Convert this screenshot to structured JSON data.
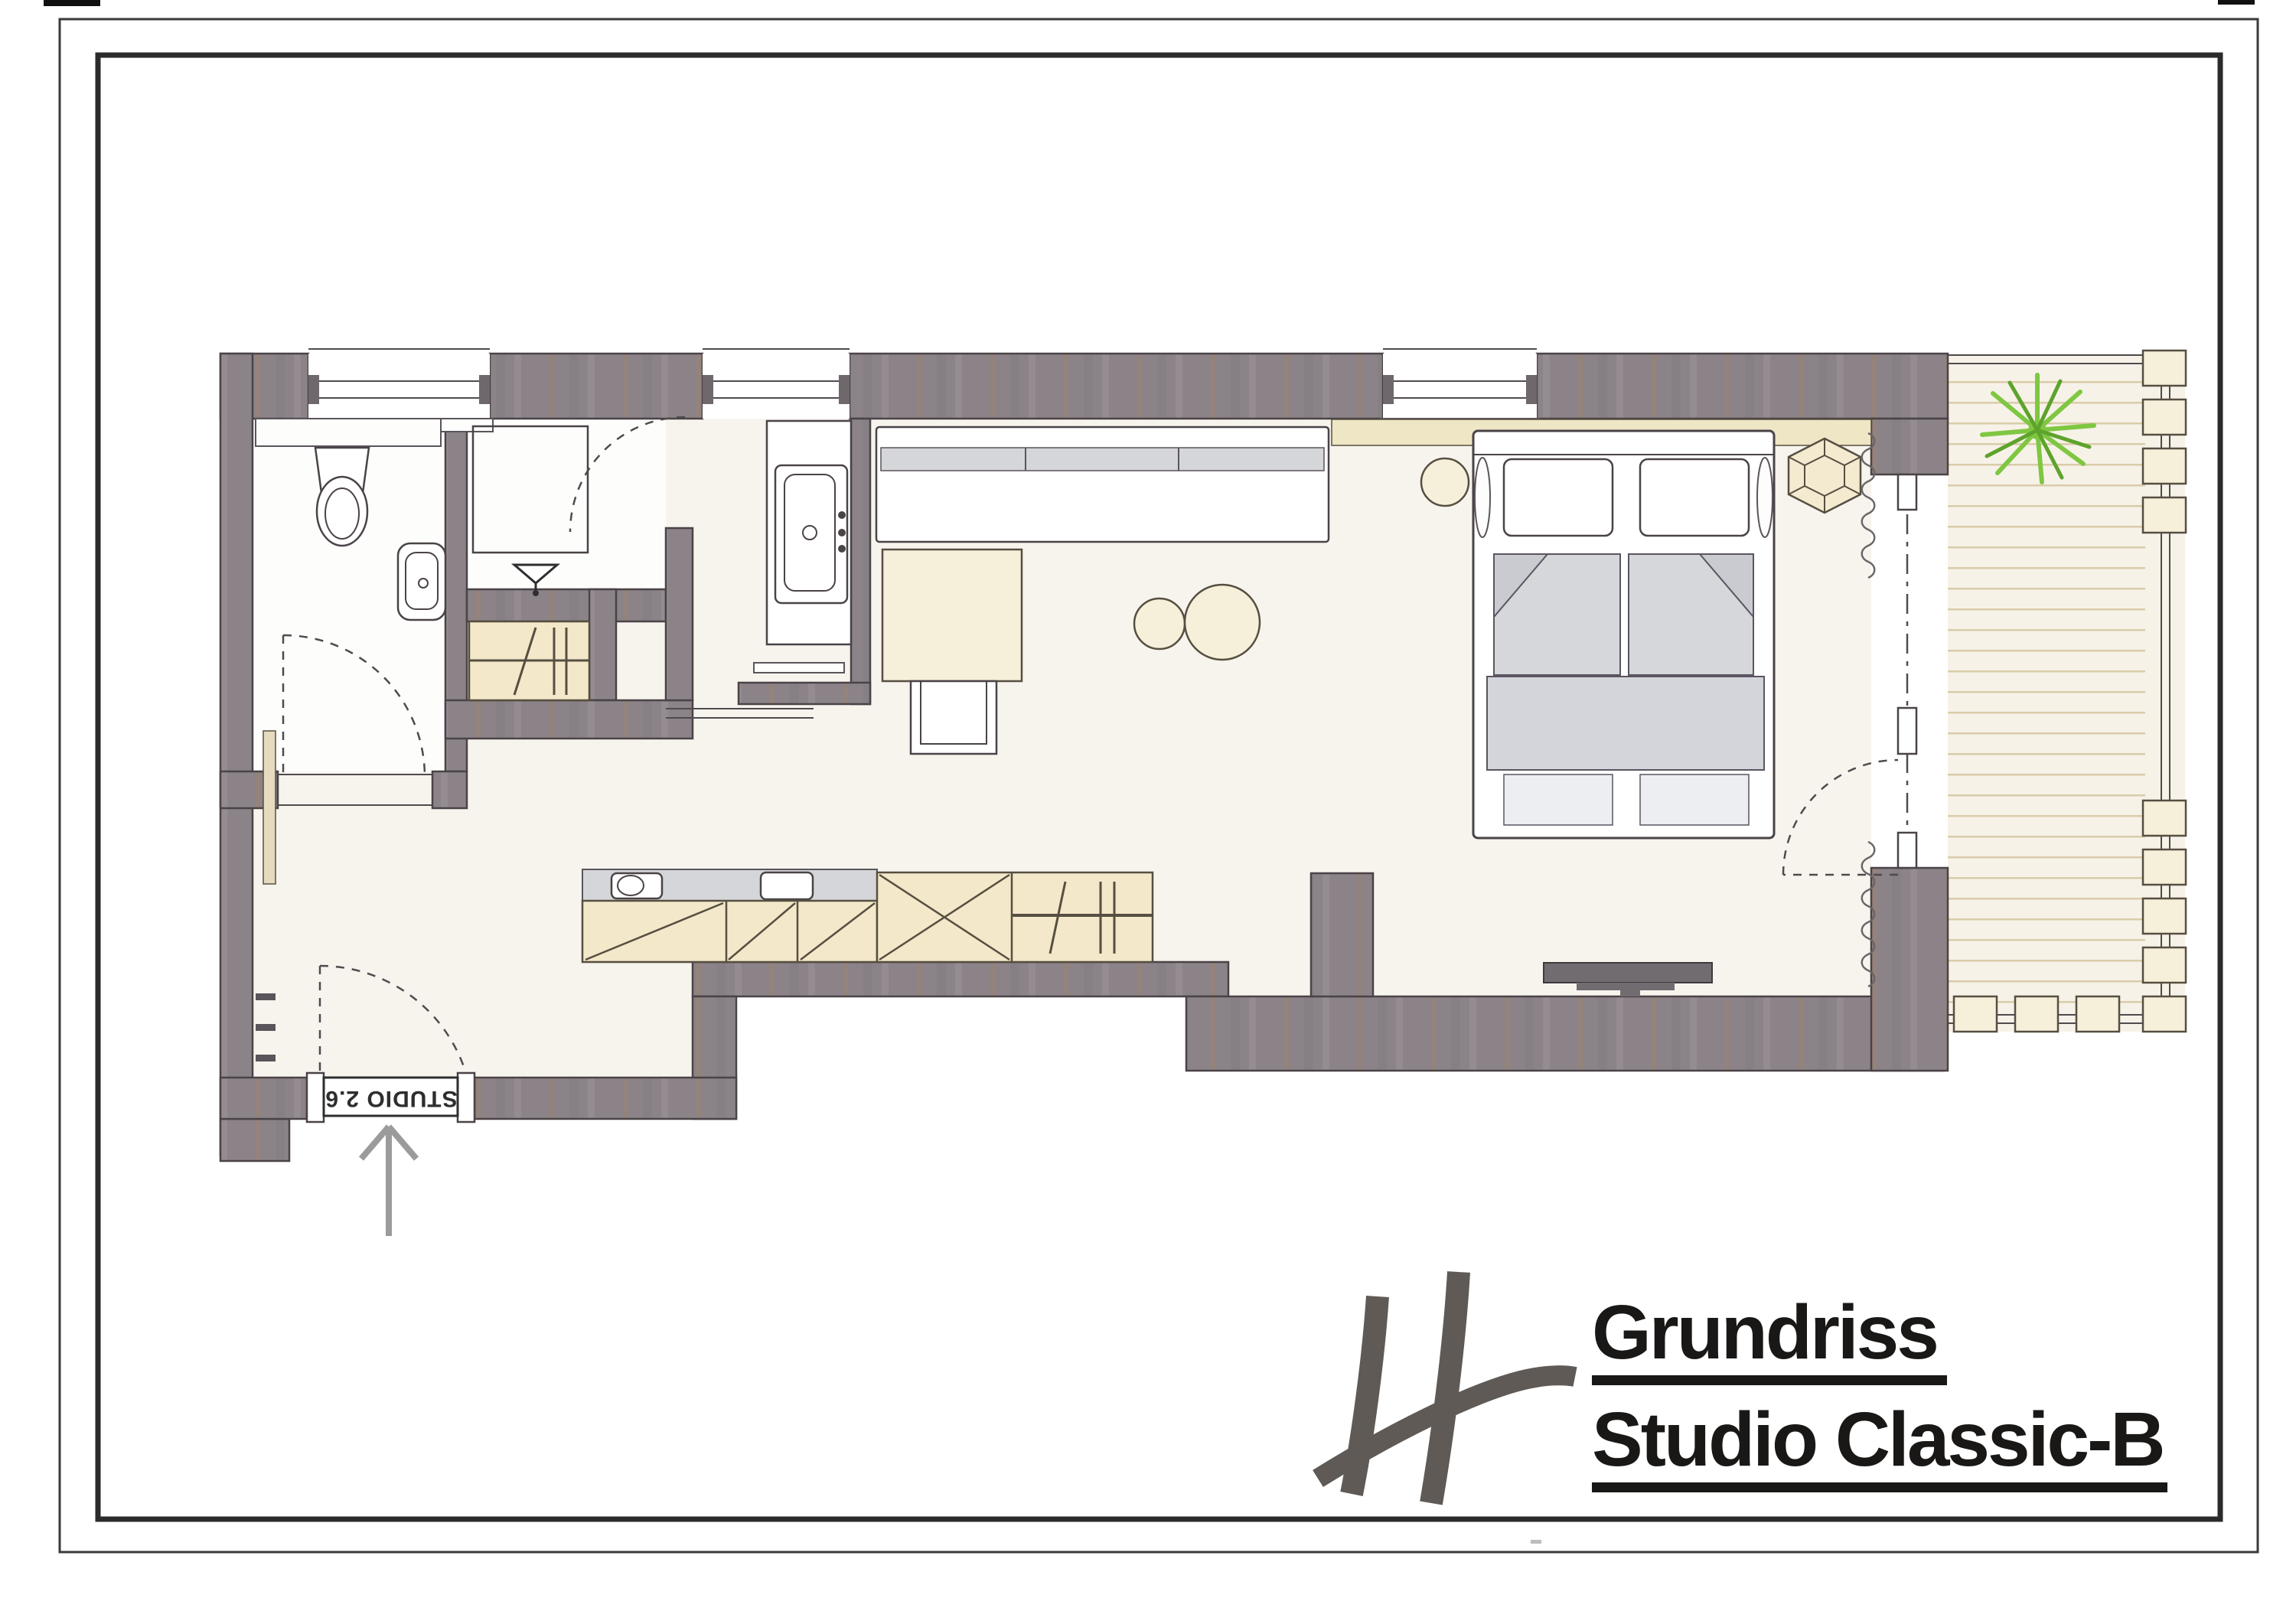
{
  "titles": {
    "line1": "Grundriss",
    "line2": "Studio Classic-B"
  },
  "entry": {
    "label": "STUDIO 2.6"
  },
  "plan": {
    "type": "hotel-room-floor-plan",
    "rooms": [
      "bathroom-wc",
      "shower-room",
      "bathtub-niche",
      "entry-hallway",
      "kitchenette",
      "living-area",
      "sleeping-area",
      "balcony"
    ],
    "fixtures": [
      "toilet",
      "washbasin",
      "shower-tray",
      "shower-drain-symbol",
      "bathtub",
      "closet-clothes-rail",
      "kitchen-sink",
      "cooktop",
      "base-cabinets",
      "wardrobe-cross",
      "wardrobe-rail",
      "console-sideboard",
      "desk",
      "desk-chair",
      "round-stool-small",
      "round-stool-large",
      "double-bed",
      "pillows",
      "duvets",
      "bed-runner",
      "round-nightstand",
      "hexagonal-side-table",
      "wall-tv",
      "curtain-symbols",
      "balcony-door",
      "deck-planks",
      "planter-posts",
      "plant"
    ]
  },
  "colors": {
    "page-bg": "#ffffff",
    "border-outer": "#3a3a3a",
    "border-inner": "#2b2b2b",
    "wall": "#8b8387",
    "wall-line": "#4a4347",
    "floor": "#f7f4ee",
    "floor-bath": "#fdfdfc",
    "furniture-beige": "#f3e8c9",
    "furniture-beige-light": "#f6efda",
    "fabric-gray": "#d6d7db",
    "fabric-gray-dark": "#c9cbd1",
    "counter-gray": "#d5d6d9",
    "runner-gray": "#d3d5da",
    "deck": "#f7f2e8",
    "deck-line": "#d9cca9",
    "plant-green": "#7fc742",
    "plant-green-dark": "#5ea32c",
    "logo-gray": "#5f5a55",
    "ink": "#1a1816",
    "text-dark": "#2f2d2e",
    "arrow-gray": "#9b9b9b"
  }
}
